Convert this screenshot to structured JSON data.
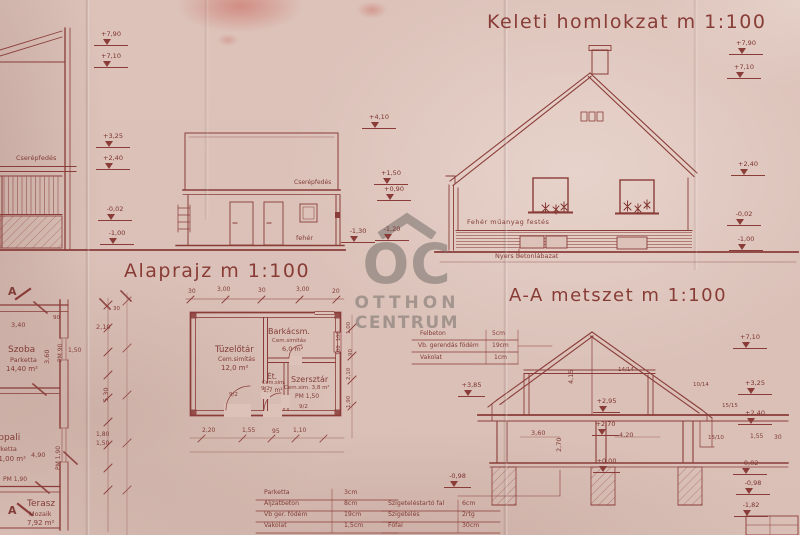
{
  "colors": {
    "ink": "#8a3c38",
    "paper": "#dcc2b9",
    "watermark_gray": "#7a746e"
  },
  "titles": {
    "east_facade": "Keleti  homlokzat  m 1:100",
    "floor_plan": "Alaprajz  m 1:100",
    "section": "A-A metszet  m 1:100"
  },
  "watermark": {
    "brand": "OC",
    "line1": "OTTHON",
    "line2": "CENTRUM"
  },
  "west_building": {
    "roof_label": "Cserépfedés",
    "markers": [
      "+7,90",
      "+7,10",
      "+3,25",
      "+2,40",
      "-0,02",
      "-1,00"
    ]
  },
  "outbuilding_elevation": {
    "roof_label": "Cserépfedés",
    "wall_label": "fehér",
    "markers": [
      "+4,10",
      "+1,50",
      "+0,90",
      "-1,30",
      "-1,20"
    ]
  },
  "east_facade": {
    "paint_label": "Fehér műanyag festés",
    "plinth_label": "Nyers betonlábazat",
    "markers": [
      "+7,90",
      "+7,10",
      "+2,40",
      "-0,02",
      "-1,00"
    ]
  },
  "floor_plan": {
    "section_letter": "A",
    "top_dims": [
      "30",
      "3,00",
      "30",
      "3,00",
      "20"
    ],
    "rooms": [
      {
        "name": "Szoba",
        "finish": "Parketta",
        "area": "14,40 m²"
      },
      {
        "name": "Nappali",
        "finish": "Parketta",
        "area": "21,00 m²"
      },
      {
        "name": "Terasz",
        "finish": "Mozaik",
        "area": "7,92 m²"
      }
    ],
    "labels": {
      "pm190h": "PM 1,90",
      "pm90v": "PM 90",
      "pm190v": "PM 1,90"
    },
    "dims": [
      "3,40",
      "3,60",
      "2,10",
      "1,50",
      "5,30",
      "1,80",
      "1,50",
      "4,90",
      "30",
      "90"
    ],
    "out_rooms": [
      {
        "name": "Tüzelőtár",
        "finish": "Cem.simítás",
        "area": "12,0 m²"
      },
      {
        "name": "Barkácsm.",
        "finish": "Cem.simítás",
        "area": "6,0 m²"
      },
      {
        "name": "Ét.",
        "finish": "Cem.sim.",
        "area": "1,7 m²"
      },
      {
        "name": "Szersztár",
        "finish": "Cem.sim. 3,8 m²",
        "extra": "PM 1,50"
      }
    ],
    "door_marks": [
      "9/2",
      "9/2",
      "9/2"
    ],
    "window_marks": [
      "100",
      "100"
    ],
    "bottom_dims": [
      "2,20",
      "1,55",
      "95",
      "1,10"
    ],
    "right_dims": [
      "1,00",
      "90",
      "2,10",
      "1,90"
    ]
  },
  "section": {
    "ceiling_table": [
      {
        "name": "Felbeton",
        "val": "5cm"
      },
      {
        "name": "Vb. gerendás födém",
        "val": "19cm"
      },
      {
        "name": "Vakolat",
        "val": "1cm"
      }
    ],
    "markers_right": [
      "+7,10",
      "+3,25",
      "+2,40",
      "-0,02",
      "-0,98",
      "-1,82"
    ],
    "markers_left": [
      "+3,85",
      "-0,98"
    ],
    "levels": [
      "+2,95",
      "+2,70",
      "±0,00"
    ],
    "dims": {
      "attic_h": "4,15",
      "room_h": "2,70",
      "room1_w": "3,60",
      "room2_w": "4,20",
      "d155": "1,55",
      "d30": "30"
    },
    "timber": [
      "14/14",
      "10/14",
      "15/15",
      "15/10"
    ]
  },
  "tables": {
    "floor": [
      {
        "name": "Parketta",
        "val": "3cm"
      },
      {
        "name": "Aljzatbeton",
        "val": "8cm"
      },
      {
        "name": "Vb ger. födém",
        "val": "19cm"
      },
      {
        "name": "Vakolat",
        "val": "1,5cm"
      }
    ],
    "wall": [
      {
        "name": "Szigeteléstartó fal",
        "val": "6cm"
      },
      {
        "name": "Szigetelés",
        "val": "2rtg"
      },
      {
        "name": "Főfal",
        "val": "30cm"
      }
    ]
  }
}
